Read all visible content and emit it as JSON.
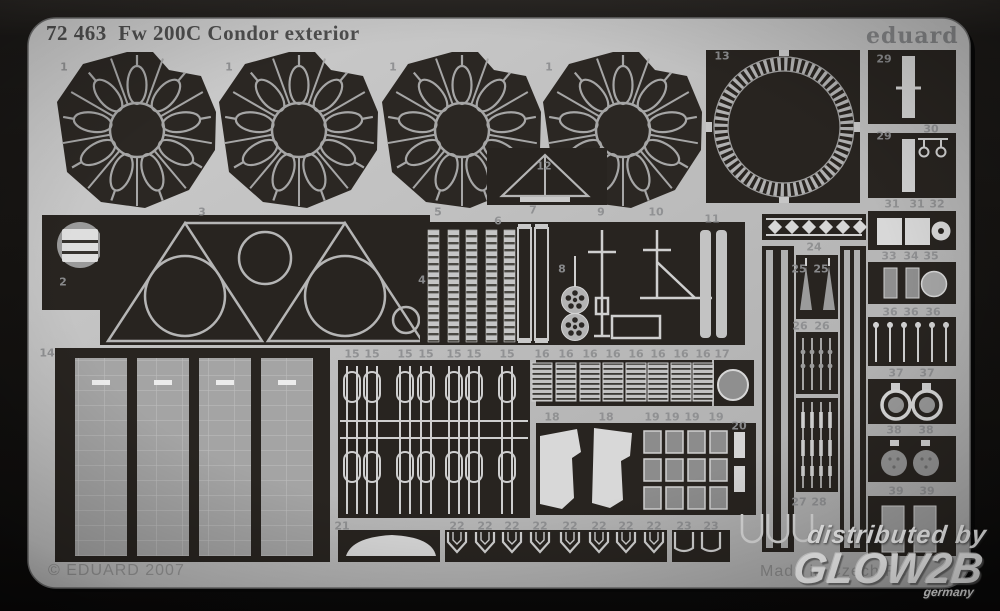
{
  "header": {
    "title": "72 463  Fw 200C Condor exterior",
    "brand": "eduard"
  },
  "footer": {
    "copyright": "© EDUARD 2007",
    "made_in": "Made in Czech Rep."
  },
  "watermark": {
    "line1": "distributed by",
    "line2": "GLOW2B",
    "line3": "germany"
  },
  "sheet": {
    "product_number": "72 463",
    "product_name": "Fw 200C Condor exterior",
    "colors": {
      "sheet_grey": "#bcbcbc",
      "etch_black": "#282420",
      "part_light": "#d2d2d2",
      "part_mid": "#9a9a9a"
    }
  },
  "part_labels": [
    {
      "n": "1",
      "x": 64,
      "y": 67
    },
    {
      "n": "1",
      "x": 229,
      "y": 67
    },
    {
      "n": "1",
      "x": 393,
      "y": 67
    },
    {
      "n": "1",
      "x": 549,
      "y": 67
    },
    {
      "n": "13",
      "x": 722,
      "y": 56
    },
    {
      "n": "29",
      "x": 884,
      "y": 59
    },
    {
      "n": "29",
      "x": 884,
      "y": 136
    },
    {
      "n": "30",
      "x": 931,
      "y": 129
    },
    {
      "n": "31",
      "x": 892,
      "y": 204
    },
    {
      "n": "31",
      "x": 917,
      "y": 204
    },
    {
      "n": "32",
      "x": 937,
      "y": 204
    },
    {
      "n": "33",
      "x": 889,
      "y": 256
    },
    {
      "n": "34",
      "x": 911,
      "y": 256
    },
    {
      "n": "35",
      "x": 931,
      "y": 256
    },
    {
      "n": "36",
      "x": 890,
      "y": 312
    },
    {
      "n": "36",
      "x": 911,
      "y": 312
    },
    {
      "n": "36",
      "x": 933,
      "y": 312
    },
    {
      "n": "37",
      "x": 896,
      "y": 373
    },
    {
      "n": "37",
      "x": 927,
      "y": 373
    },
    {
      "n": "38",
      "x": 894,
      "y": 430
    },
    {
      "n": "38",
      "x": 926,
      "y": 430
    },
    {
      "n": "39",
      "x": 896,
      "y": 491
    },
    {
      "n": "39",
      "x": 927,
      "y": 491
    },
    {
      "n": "2",
      "x": 63,
      "y": 282
    },
    {
      "n": "3",
      "x": 202,
      "y": 212
    },
    {
      "n": "4",
      "x": 422,
      "y": 280
    },
    {
      "n": "5",
      "x": 438,
      "y": 212
    },
    {
      "n": "6",
      "x": 498,
      "y": 221
    },
    {
      "n": "7",
      "x": 533,
      "y": 210
    },
    {
      "n": "8",
      "x": 562,
      "y": 269
    },
    {
      "n": "9",
      "x": 601,
      "y": 212
    },
    {
      "n": "10",
      "x": 656,
      "y": 212
    },
    {
      "n": "11",
      "x": 712,
      "y": 219
    },
    {
      "n": "12",
      "x": 544,
      "y": 166
    },
    {
      "n": "14",
      "x": 47,
      "y": 353
    },
    {
      "n": "15",
      "x": 352,
      "y": 354
    },
    {
      "n": "15",
      "x": 372,
      "y": 354
    },
    {
      "n": "15",
      "x": 405,
      "y": 354
    },
    {
      "n": "15",
      "x": 426,
      "y": 354
    },
    {
      "n": "15",
      "x": 454,
      "y": 354
    },
    {
      "n": "15",
      "x": 474,
      "y": 354
    },
    {
      "n": "15",
      "x": 507,
      "y": 354
    },
    {
      "n": "16",
      "x": 542,
      "y": 354
    },
    {
      "n": "16",
      "x": 566,
      "y": 354
    },
    {
      "n": "16",
      "x": 590,
      "y": 354
    },
    {
      "n": "16",
      "x": 613,
      "y": 354
    },
    {
      "n": "16",
      "x": 636,
      "y": 354
    },
    {
      "n": "16",
      "x": 658,
      "y": 354
    },
    {
      "n": "16",
      "x": 681,
      "y": 354
    },
    {
      "n": "16",
      "x": 703,
      "y": 354
    },
    {
      "n": "17",
      "x": 722,
      "y": 354
    },
    {
      "n": "18",
      "x": 552,
      "y": 417
    },
    {
      "n": "18",
      "x": 606,
      "y": 417
    },
    {
      "n": "19",
      "x": 652,
      "y": 417
    },
    {
      "n": "19",
      "x": 672,
      "y": 417
    },
    {
      "n": "19",
      "x": 692,
      "y": 417
    },
    {
      "n": "19",
      "x": 716,
      "y": 417
    },
    {
      "n": "20",
      "x": 739,
      "y": 426
    },
    {
      "n": "21",
      "x": 342,
      "y": 526
    },
    {
      "n": "22",
      "x": 457,
      "y": 526
    },
    {
      "n": "22",
      "x": 485,
      "y": 526
    },
    {
      "n": "22",
      "x": 512,
      "y": 526
    },
    {
      "n": "22",
      "x": 540,
      "y": 526
    },
    {
      "n": "22",
      "x": 570,
      "y": 526
    },
    {
      "n": "22",
      "x": 599,
      "y": 526
    },
    {
      "n": "22",
      "x": 626,
      "y": 526
    },
    {
      "n": "22",
      "x": 654,
      "y": 526
    },
    {
      "n": "23",
      "x": 684,
      "y": 526
    },
    {
      "n": "23",
      "x": 711,
      "y": 526
    },
    {
      "n": "24",
      "x": 814,
      "y": 247
    },
    {
      "n": "25",
      "x": 799,
      "y": 269
    },
    {
      "n": "25",
      "x": 821,
      "y": 269
    },
    {
      "n": "26",
      "x": 800,
      "y": 326
    },
    {
      "n": "26",
      "x": 822,
      "y": 326
    },
    {
      "n": "27",
      "x": 799,
      "y": 502
    },
    {
      "n": "28",
      "x": 819,
      "y": 502
    }
  ]
}
